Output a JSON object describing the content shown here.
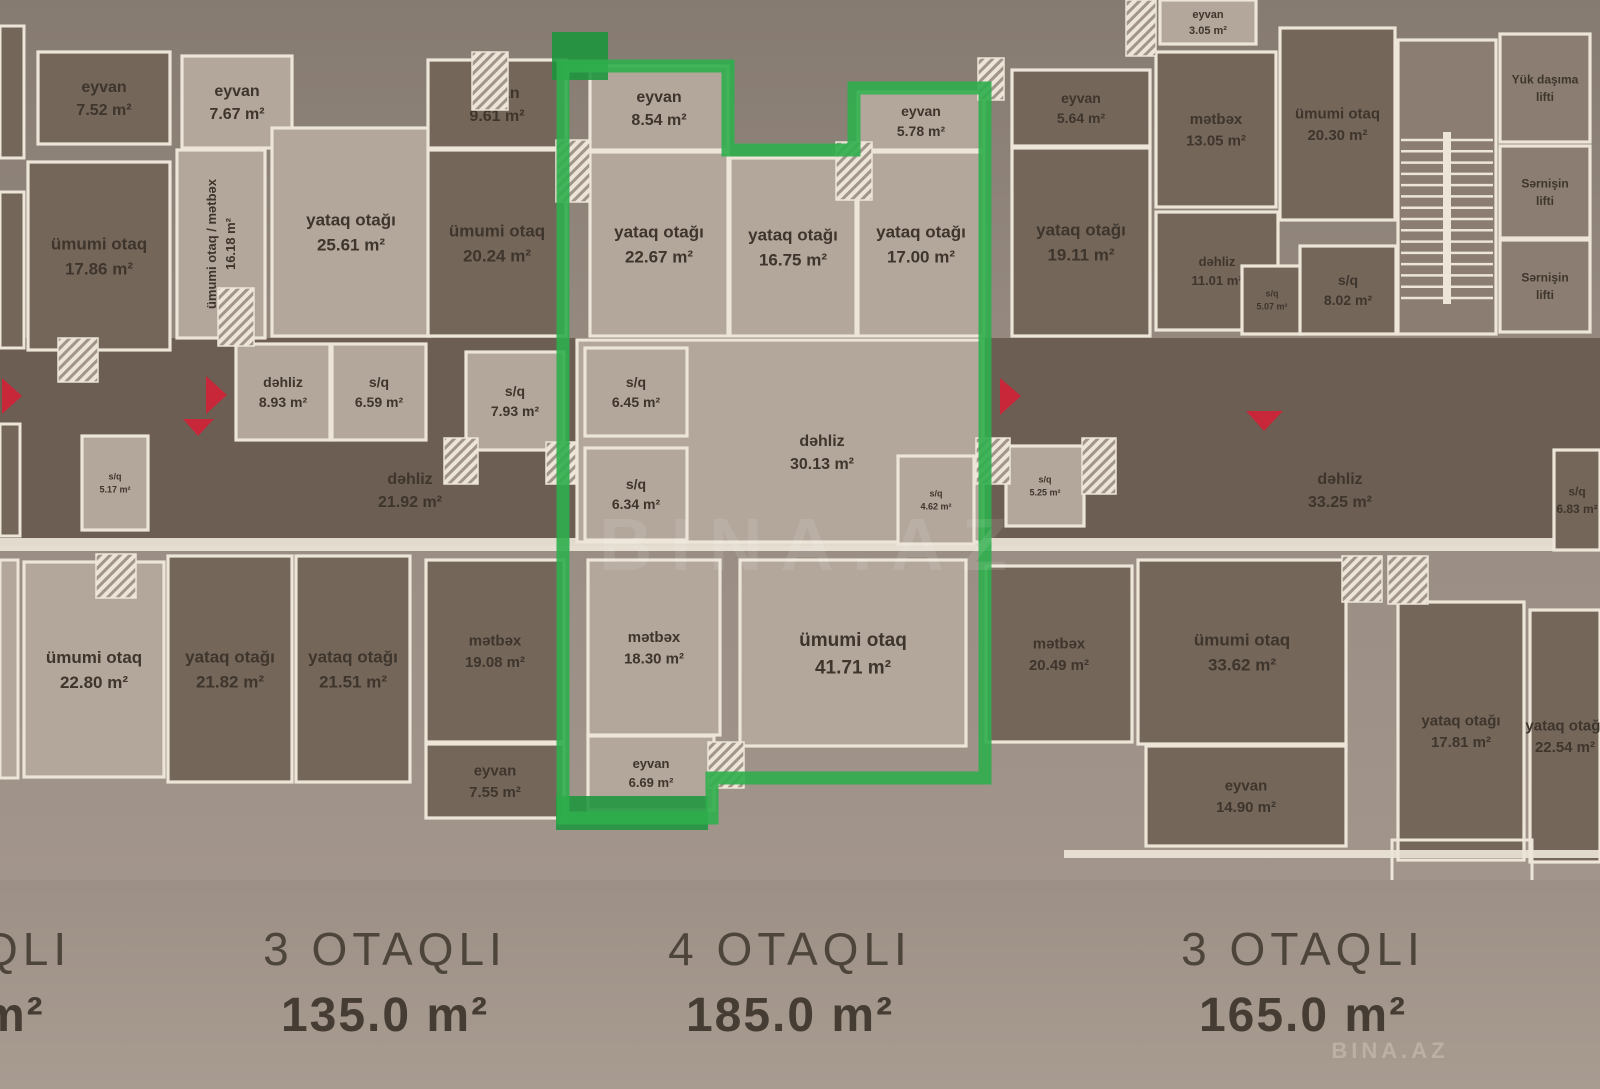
{
  "palette": {
    "bg_top": "#867b71",
    "bg_mid": "#968a80",
    "bg_bottom": "#a2958b",
    "corridor": "#6c5e52",
    "wall": "#ece5d8",
    "text": "#3e352c",
    "dark": "#75665a",
    "light": "#b3a69b",
    "mid": "#8b7d71",
    "green": "#2fae4d",
    "green_dark": "#18953b",
    "red": "#c8273a"
  },
  "corridor": {
    "rect": [
      0,
      338,
      1600,
      208
    ]
  },
  "south_wall": {
    "rect": [
      0,
      538,
      1600,
      13
    ]
  },
  "partials": [
    {
      "rect": [
        0,
        26,
        24,
        132
      ],
      "fill": "dark"
    },
    {
      "rect": [
        0,
        192,
        24,
        156
      ],
      "fill": "dark"
    },
    {
      "rect": [
        0,
        424,
        20,
        112
      ],
      "fill": "dark"
    },
    {
      "rect": [
        0,
        560,
        18,
        218
      ],
      "fill": "light"
    }
  ],
  "rooms": [
    {
      "id": "balcony-752",
      "lines": [
        "eyvan",
        "7.52 m²"
      ],
      "rect": [
        38,
        52,
        132,
        92
      ],
      "fill": "dark",
      "fs": 16
    },
    {
      "id": "balcony-767",
      "lines": [
        "eyvan",
        "7.67 m²"
      ],
      "rect": [
        182,
        56,
        110,
        92
      ],
      "fill": "light",
      "fs": 16
    },
    {
      "id": "living-1786",
      "lines": [
        "ümumi otaq",
        "17.86 m²"
      ],
      "rect": [
        28,
        162,
        142,
        188
      ],
      "fill": "dark"
    },
    {
      "id": "living-kitchen-1618",
      "lines": [
        "ümumi otaq / mətbəx",
        "16.18 m²"
      ],
      "rect": [
        177,
        150,
        88,
        188
      ],
      "fill": "light",
      "rotate": -90,
      "fs": 13
    },
    {
      "id": "bedroom-2561",
      "lines": [
        "yataq otağı",
        "25.61 m²"
      ],
      "rect": [
        272,
        128,
        158,
        208
      ],
      "fill": "light"
    },
    {
      "id": "balcony-961",
      "lines": [
        "eyvan",
        "9.61 m²"
      ],
      "rect": [
        428,
        60,
        138,
        88
      ],
      "fill": "dark",
      "fs": 16
    },
    {
      "id": "living-2024",
      "lines": [
        "ümumi otaq",
        "20.24 m²"
      ],
      "rect": [
        428,
        150,
        138,
        186
      ],
      "fill": "dark"
    },
    {
      "id": "balcony-854",
      "lines": [
        "eyvan",
        "8.54 m²"
      ],
      "rect": [
        590,
        66,
        138,
        84
      ],
      "fill": "light",
      "fs": 16
    },
    {
      "id": "bedroom-2267",
      "lines": [
        "yataq otağı",
        "22.67 m²"
      ],
      "rect": [
        590,
        152,
        138,
        184
      ],
      "fill": "light"
    },
    {
      "id": "bedroom-1675",
      "lines": [
        "yataq otağı",
        "16.75 m²"
      ],
      "rect": [
        730,
        158,
        126,
        178
      ],
      "fill": "light"
    },
    {
      "id": "balcony-578",
      "lines": [
        "eyvan",
        "5.78 m²"
      ],
      "rect": [
        858,
        92,
        126,
        58
      ],
      "fill": "light",
      "fs": 14
    },
    {
      "id": "bedroom-1700",
      "lines": [
        "yataq otağı",
        "17.00 m²"
      ],
      "rect": [
        858,
        152,
        126,
        184
      ],
      "fill": "light"
    },
    {
      "id": "balcony-564",
      "lines": [
        "eyvan",
        "5.64 m²"
      ],
      "rect": [
        1012,
        70,
        138,
        76
      ],
      "fill": "dark",
      "fs": 14
    },
    {
      "id": "bedroom-1911",
      "lines": [
        "yataq otağı",
        "19.11 m²"
      ],
      "rect": [
        1012,
        148,
        138,
        188
      ],
      "fill": "dark"
    },
    {
      "id": "balcony-305",
      "lines": [
        "eyvan",
        "3.05 m²"
      ],
      "rect": [
        1160,
        0,
        96,
        44
      ],
      "fill": "light",
      "fs": 11
    },
    {
      "id": "kitchen-1305",
      "lines": [
        "mətbəx",
        "13.05 m²"
      ],
      "rect": [
        1156,
        52,
        120,
        155
      ],
      "fill": "dark",
      "fs": 15
    },
    {
      "id": "living-2030",
      "lines": [
        "ümumi otaq",
        "20.30 m²"
      ],
      "rect": [
        1280,
        28,
        115,
        192
      ],
      "fill": "dark",
      "fs": 15
    },
    {
      "id": "hall-1101",
      "lines": [
        "dəhliz",
        "11.01 m²"
      ],
      "rect": [
        1156,
        212,
        122,
        118
      ],
      "fill": "dark",
      "fs": 13
    },
    {
      "id": "wc-507",
      "lines": [
        "s/q",
        "5.07 m²"
      ],
      "rect": [
        1242,
        266,
        60,
        68
      ],
      "fill": "dark",
      "fs": 9
    },
    {
      "id": "wc-802",
      "lines": [
        "s/q",
        "8.02 m²"
      ],
      "rect": [
        1300,
        246,
        96,
        88
      ],
      "fill": "dark",
      "fs": 14
    },
    {
      "id": "staircase",
      "lines": [],
      "rect": [
        1398,
        40,
        98,
        294
      ],
      "fill": "mid"
    },
    {
      "id": "cargo-lift",
      "lines": [
        "Yük daşıma",
        "lifti"
      ],
      "rect": [
        1500,
        34,
        90,
        108
      ],
      "fill": "mid",
      "fs": 12
    },
    {
      "id": "passenger-lift-1",
      "lines": [
        "Sərnişin",
        "lifti"
      ],
      "rect": [
        1500,
        146,
        90,
        92
      ],
      "fill": "mid",
      "fs": 12
    },
    {
      "id": "passenger-lift-2",
      "lines": [
        "Sərnişin",
        "lifti"
      ],
      "rect": [
        1500,
        240,
        90,
        92
      ],
      "fill": "mid",
      "fs": 12
    },
    {
      "id": "hall-893",
      "lines": [
        "dəhliz",
        "8.93 m²"
      ],
      "rect": [
        236,
        344,
        94,
        96
      ],
      "fill": "light",
      "fs": 14
    },
    {
      "id": "wc-659",
      "lines": [
        "s/q",
        "6.59 m²"
      ],
      "rect": [
        332,
        344,
        94,
        96
      ],
      "fill": "light",
      "fs": 14
    },
    {
      "id": "wc-793",
      "lines": [
        "s/q",
        "7.93 m²"
      ],
      "rect": [
        466,
        352,
        98,
        98
      ],
      "fill": "light",
      "fs": 14
    },
    {
      "id": "wc-517",
      "lines": [
        "s/q",
        "5.17 m²"
      ],
      "rect": [
        82,
        436,
        66,
        94
      ],
      "fill": "light",
      "fs": 9
    },
    {
      "id": "apt-corridor",
      "lines": [
        "dəhliz",
        "30.13 m²"
      ],
      "rect": [
        577,
        340,
        406,
        202
      ],
      "fill": "light",
      "label": [
        822,
        452
      ],
      "fs": 16
    },
    {
      "id": "wc-645",
      "lines": [
        "s/q",
        "6.45 m²"
      ],
      "rect": [
        585,
        348,
        102,
        88
      ],
      "fill": "light",
      "fs": 14
    },
    {
      "id": "wc-634",
      "lines": [
        "s/q",
        "6.34 m²"
      ],
      "rect": [
        585,
        448,
        102,
        92
      ],
      "fill": "light",
      "fs": 14
    },
    {
      "id": "wc-462",
      "lines": [
        "s/q",
        "4.62 m²"
      ],
      "rect": [
        898,
        456,
        76,
        88
      ],
      "fill": "light",
      "fs": 9
    },
    {
      "id": "wc-525",
      "lines": [
        "s/q",
        "5.25 m²"
      ],
      "rect": [
        1006,
        446,
        78,
        80
      ],
      "fill": "light",
      "fs": 9
    },
    {
      "id": "hall-2192",
      "lines": [
        "dəhliz",
        "21.92 m²"
      ],
      "rect": [
        250,
        440,
        320,
        100
      ],
      "fill": "none",
      "fs": 16
    },
    {
      "id": "hall-3325",
      "lines": [
        "dəhliz",
        "33.25 m²"
      ],
      "rect": [
        1180,
        440,
        320,
        100
      ],
      "fill": "none",
      "fs": 16
    },
    {
      "id": "wc-683",
      "lines": [
        "s/q",
        "6.83 m²"
      ],
      "rect": [
        1554,
        450,
        46,
        100
      ],
      "fill": "dark",
      "fs": 12
    },
    {
      "id": "living-2280",
      "lines": [
        "ümumi otaq",
        "22.80 m²"
      ],
      "rect": [
        24,
        562,
        140,
        215
      ],
      "fill": "light"
    },
    {
      "id": "bedroom-2182",
      "lines": [
        "yataq otağı",
        "21.82 m²"
      ],
      "rect": [
        168,
        556,
        124,
        226
      ],
      "fill": "dark"
    },
    {
      "id": "bedroom-2151",
      "lines": [
        "yataq otağı",
        "21.51 m²"
      ],
      "rect": [
        296,
        556,
        114,
        226
      ],
      "fill": "dark"
    },
    {
      "id": "kitchen-1908",
      "lines": [
        "mətbəx",
        "19.08 m²"
      ],
      "rect": [
        426,
        560,
        138,
        182
      ],
      "fill": "dark",
      "fs": 15
    },
    {
      "id": "balcony-755",
      "lines": [
        "eyvan",
        "7.55 m²"
      ],
      "rect": [
        426,
        744,
        138,
        74
      ],
      "fill": "dark",
      "fs": 15
    },
    {
      "id": "kitchen-1830",
      "lines": [
        "mətbəx",
        "18.30 m²"
      ],
      "rect": [
        588,
        560,
        132,
        175
      ],
      "fill": "light",
      "fs": 15
    },
    {
      "id": "balcony-669",
      "lines": [
        "eyvan",
        "6.69 m²"
      ],
      "rect": [
        588,
        736,
        126,
        74
      ],
      "fill": "light",
      "fs": 13
    },
    {
      "id": "living-4171",
      "lines": [
        "ümumi otaq",
        "41.71 m²"
      ],
      "rect": [
        740,
        560,
        226,
        186
      ],
      "fill": "light",
      "fs": 19
    },
    {
      "id": "kitchen-2049",
      "lines": [
        "mətbəx",
        "20.49 m²"
      ],
      "rect": [
        986,
        566,
        146,
        176
      ],
      "fill": "dark",
      "fs": 15
    },
    {
      "id": "living-3362",
      "lines": [
        "ümumi otaq",
        "33.62 m²"
      ],
      "rect": [
        1138,
        560,
        208,
        184
      ],
      "fill": "dark"
    },
    {
      "id": "balcony-1490",
      "lines": [
        "eyvan",
        "14.90 m²"
      ],
      "rect": [
        1146,
        746,
        200,
        100
      ],
      "fill": "dark",
      "fs": 15
    },
    {
      "id": "bedroom-1781",
      "lines": [
        "yataq otağı",
        "17.81 m²"
      ],
      "rect": [
        1398,
        602,
        126,
        258
      ],
      "fill": "dark",
      "fs": 15
    },
    {
      "id": "bedroom-2254",
      "lines": [
        "yataq otağı",
        "22.54 m²"
      ],
      "rect": [
        1530,
        610,
        70,
        252
      ],
      "fill": "dark",
      "fs": 15
    }
  ],
  "pillars": [
    [
      472,
      52,
      36,
      58
    ],
    [
      556,
      140,
      34,
      62
    ],
    [
      836,
      142,
      36,
      58
    ],
    [
      978,
      58,
      26,
      42
    ],
    [
      1126,
      0,
      30,
      56
    ],
    [
      58,
      338,
      40,
      44
    ],
    [
      218,
      288,
      36,
      58
    ],
    [
      444,
      438,
      34,
      46
    ],
    [
      546,
      442,
      30,
      42
    ],
    [
      976,
      438,
      34,
      46
    ],
    [
      1082,
      438,
      34,
      56
    ],
    [
      1342,
      556,
      40,
      46
    ],
    [
      708,
      742,
      36,
      46
    ],
    [
      96,
      554,
      40,
      44
    ],
    [
      1388,
      556,
      40,
      48
    ]
  ],
  "stairs": {
    "treads": {
      "x1": 1401,
      "x2": 1493,
      "y_start": 140,
      "y_end": 298,
      "count": 15
    },
    "spine": [
      1443,
      132,
      8,
      172
    ]
  },
  "extra_walls": [
    [
      1064,
      850,
      536,
      8
    ]
  ],
  "outline_boxes": [
    [
      1392,
      840,
      140,
      62
    ]
  ],
  "highlight": {
    "points": "563,66 728,66 728,150 854,150 854,88 985,88 985,778 712,778 712,818 563,818",
    "blocks": [
      [
        552,
        32,
        56,
        48
      ],
      [
        556,
        796,
        152,
        34
      ]
    ]
  },
  "arrows": {
    "shapes": [
      "2,378 22,396 2,414",
      "206,376 227,395 206,414",
      "183,419 214,419 198,436",
      "1000,378 1021,396 1000,415",
      "1246,411 1283,411 1264,431"
    ]
  },
  "summary": [
    {
      "name": "QLI",
      "area": "m²"
    },
    {
      "name": "3 OTAQLI",
      "area": "135.0 m²"
    },
    {
      "name": "4 OTAQLI",
      "area": "185.0 m²"
    },
    {
      "name": "3 OTAQLI",
      "area": "165.0 m²"
    }
  ],
  "watermark": {
    "center": "BINA.AZ",
    "corner": "BINA.AZ"
  }
}
